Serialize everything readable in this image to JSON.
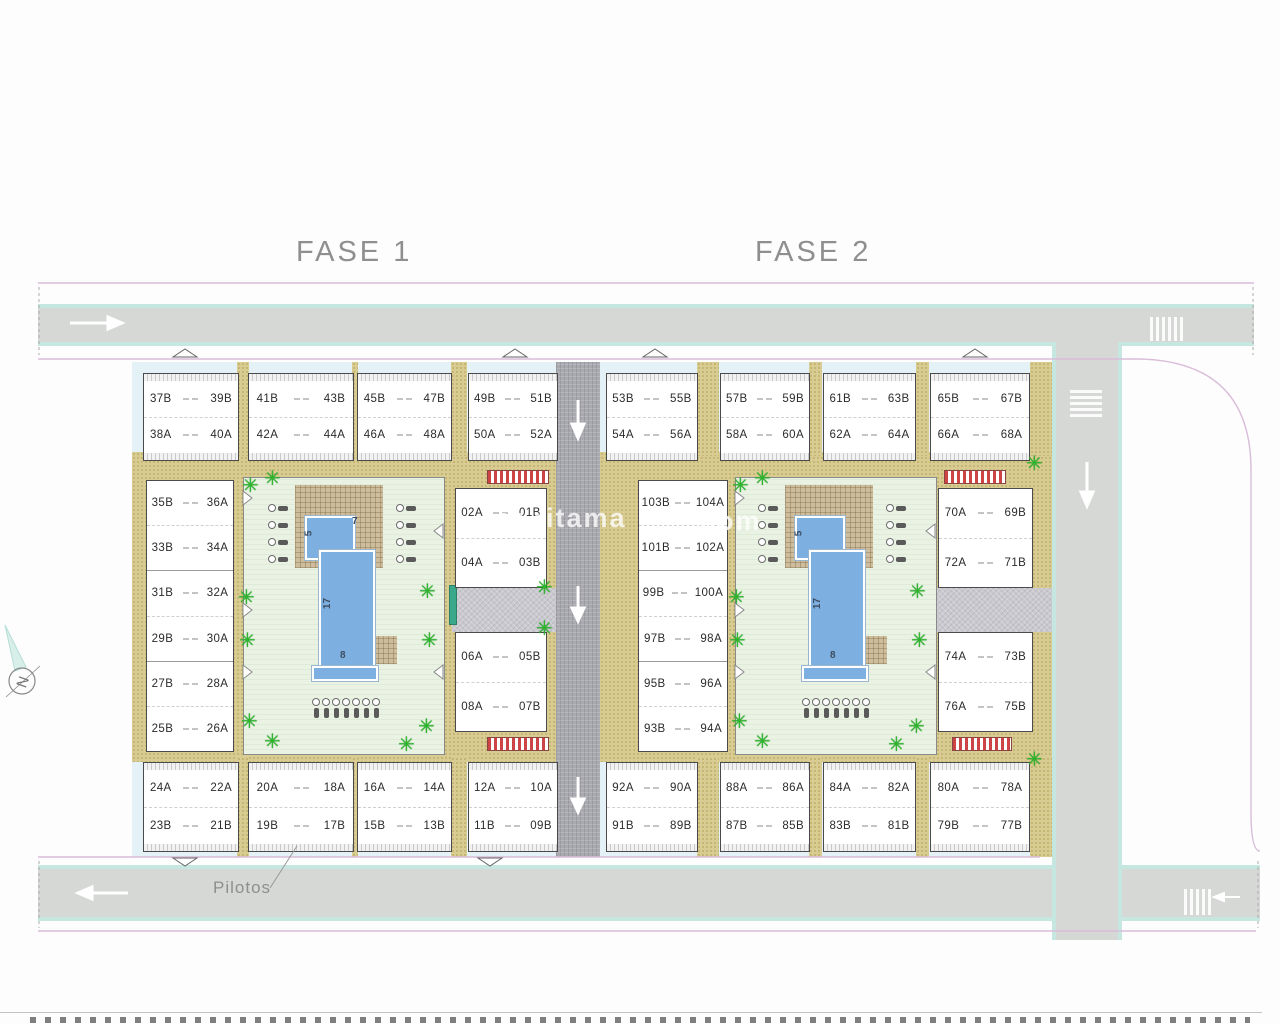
{
  "page": {
    "fase1_label": "FASE 1",
    "fase2_label": "FASE 2",
    "pilotos_label": "Pilotos",
    "watermark_left": "w.ritama",
    "watermark_right": "com",
    "compass_letter": "N"
  },
  "pool": {
    "fase1": {
      "top_width": "7",
      "small_depth": "5",
      "length": "17",
      "bottom_width": "8"
    },
    "fase2": {
      "small_depth": "5",
      "length": "17",
      "bottom_width": "8"
    }
  },
  "colors": {
    "road_gray": "#d6d8d5",
    "road_edge_cyan": "#c6e6e0",
    "boundary_pink": "#d9bcd9",
    "path_khaki": "#d9cc92",
    "courtyard_green": "#e9f2e3",
    "pool_blue": "#7db0e0",
    "deck_tan": "#cdbd9d",
    "tree_green": "#2db52d",
    "pergola_red": "#cc4444",
    "center_road_gray": "#a9a9b0",
    "fase_label_gray": "#8f8f8f"
  },
  "blocks": {
    "top_row": [
      {
        "units": [
          [
            "37B",
            "39B"
          ],
          [
            "38A",
            "40A"
          ]
        ]
      },
      {
        "units": [
          [
            "41B",
            "43B"
          ],
          [
            "42A",
            "44A"
          ]
        ]
      },
      {
        "units": [
          [
            "45B",
            "47B"
          ],
          [
            "46A",
            "48A"
          ]
        ]
      },
      {
        "units": [
          [
            "49B",
            "51B"
          ],
          [
            "50A",
            "52A"
          ]
        ]
      },
      {
        "units": [
          [
            "53B",
            "55B"
          ],
          [
            "54A",
            "56A"
          ]
        ]
      },
      {
        "units": [
          [
            "57B",
            "59B"
          ],
          [
            "58A",
            "60A"
          ]
        ]
      },
      {
        "units": [
          [
            "61B",
            "63B"
          ],
          [
            "62A",
            "64A"
          ]
        ]
      },
      {
        "units": [
          [
            "65B",
            "67B"
          ],
          [
            "66A",
            "68A"
          ]
        ]
      }
    ],
    "bottom_row": [
      {
        "units": [
          [
            "24A",
            "22A"
          ],
          [
            "23B",
            "21B"
          ]
        ]
      },
      {
        "units": [
          [
            "20A",
            "18A"
          ],
          [
            "19B",
            "17B"
          ]
        ]
      },
      {
        "units": [
          [
            "16A",
            "14A"
          ],
          [
            "15B",
            "13B"
          ]
        ]
      },
      {
        "units": [
          [
            "12A",
            "10A"
          ],
          [
            "11B",
            "09B"
          ]
        ]
      },
      {
        "units": [
          [
            "92A",
            "90A"
          ],
          [
            "91B",
            "89B"
          ]
        ]
      },
      {
        "units": [
          [
            "88A",
            "86A"
          ],
          [
            "87B",
            "85B"
          ]
        ]
      },
      {
        "units": [
          [
            "84A",
            "82A"
          ],
          [
            "83B",
            "81B"
          ]
        ]
      },
      {
        "units": [
          [
            "80A",
            "78A"
          ],
          [
            "79B",
            "77B"
          ]
        ]
      }
    ],
    "left_column": {
      "units": [
        [
          "35B",
          "36A"
        ],
        [
          "33B",
          "34A"
        ],
        [
          "31B",
          "32A"
        ],
        [
          "29B",
          "30A"
        ],
        [
          "27B",
          "28A"
        ],
        [
          "25B",
          "26A"
        ]
      ]
    },
    "mid_column_upper": {
      "units": [
        [
          "02A",
          "01B"
        ],
        [
          "04A",
          "03B"
        ]
      ]
    },
    "mid_column_lower": {
      "units": [
        [
          "06A",
          "05B"
        ],
        [
          "08A",
          "07B"
        ]
      ]
    },
    "inner_column_f2": {
      "units": [
        [
          "103B",
          "104A"
        ],
        [
          "101B",
          "102A"
        ],
        [
          "99B",
          "100A"
        ],
        [
          "97B",
          "98A"
        ],
        [
          "95B",
          "96A"
        ],
        [
          "93B",
          "94A"
        ]
      ]
    },
    "right_column_upper": {
      "units": [
        [
          "70A",
          "69B"
        ],
        [
          "72A",
          "71B"
        ]
      ]
    },
    "right_column_lower": {
      "units": [
        [
          "74A",
          "73B"
        ],
        [
          "76A",
          "75B"
        ]
      ]
    }
  }
}
